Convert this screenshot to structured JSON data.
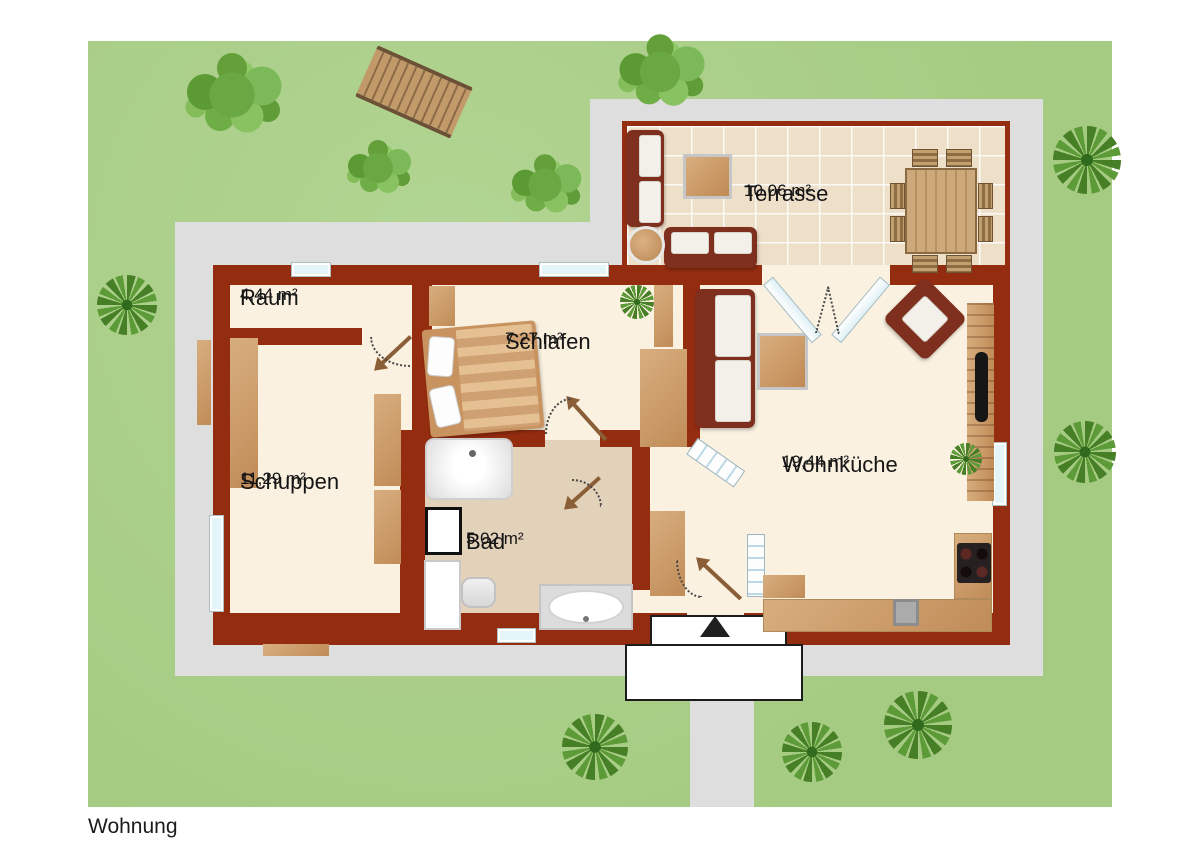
{
  "footer": {
    "label": "Wohnung"
  },
  "rooms": {
    "terrasse": {
      "name": "Terrasse",
      "area": "10,06 m²"
    },
    "raum": {
      "name": "Raum",
      "area": "4,44 m²"
    },
    "schlafen": {
      "name": "Schlafen",
      "area": "7,27 m²"
    },
    "schuppen": {
      "name": "Schuppen",
      "area": "11,29 m²"
    },
    "bad": {
      "name": "Bad",
      "area": "5,02 m²"
    },
    "wohnkueche": {
      "name": "Wohnküche",
      "area": "19,44 m²"
    }
  },
  "colors": {
    "wall": "#942c10",
    "floor": "#faf1e0",
    "terrace_tile": "#eedfc8",
    "lawn": "#a9ce88",
    "path": "#dedede",
    "wood": "#c89a6b",
    "sofa": "#7e2f1e"
  },
  "icons": {
    "entrance_arrow": "triangle-up"
  }
}
